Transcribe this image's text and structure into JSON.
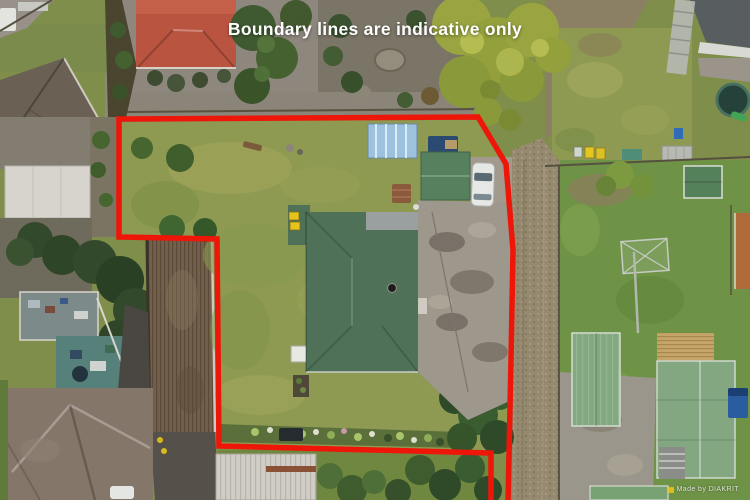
{
  "overlay": {
    "disclaimer_text": "Boundary lines are indicative only",
    "text_color": "#ffffff"
  },
  "watermark": {
    "text": "Made by DIAKRIT"
  },
  "boundary": {
    "color": "#ee1509"
  },
  "scene": {
    "type": "aerial-drone-photo-of-residential-property",
    "main_roof_color": "#4e7157",
    "lawn_color": "#8e9a52"
  }
}
